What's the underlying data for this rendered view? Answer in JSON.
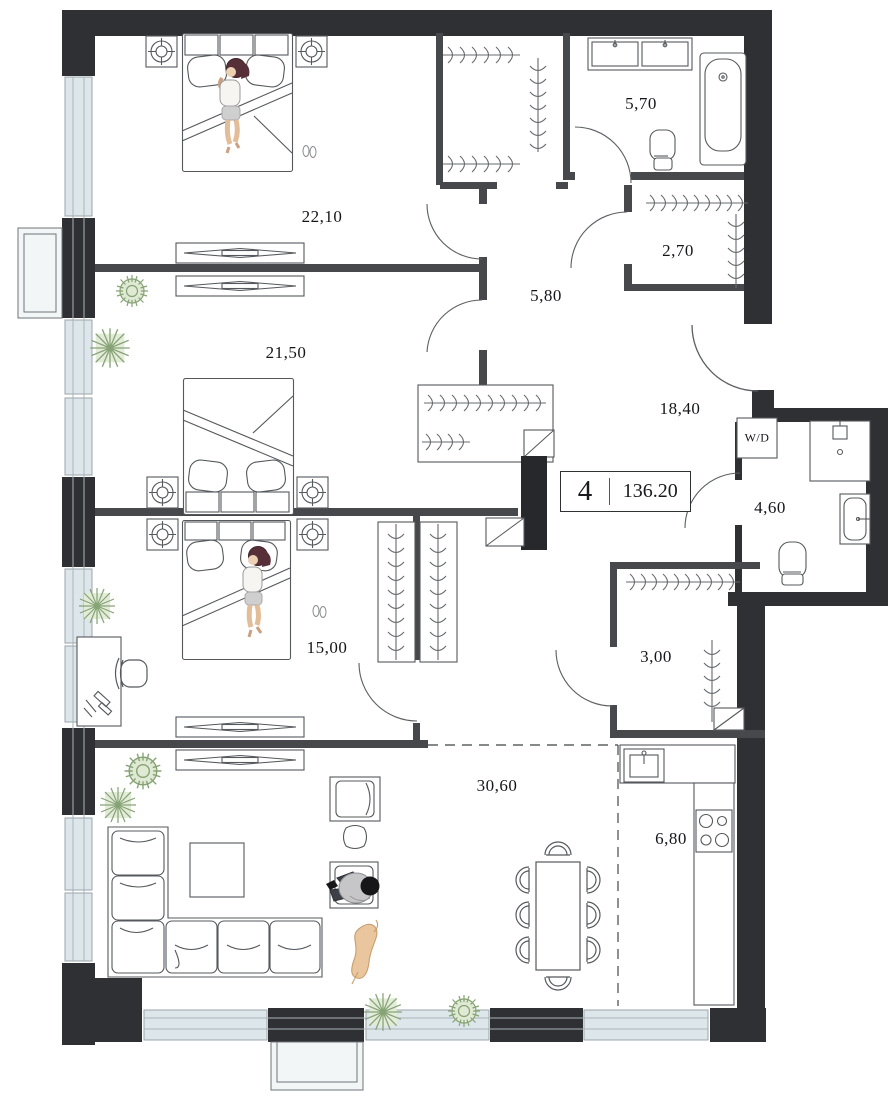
{
  "floor_plan": {
    "unit_badge": {
      "rooms_count": "4",
      "total_area": "136.20"
    },
    "room_areas": {
      "bedroom_top": "22,10",
      "bathroom_top": "5,70",
      "dressing_top": "2,70",
      "hallway_inner": "5,80",
      "bedroom_middle": "21,50",
      "hallway_entry": "18,40",
      "bathroom_side": "4,60",
      "bedroom_lower": "15,00",
      "dressing_middle": "3,00",
      "living_room": "30,60",
      "kitchen": "6,80"
    },
    "appliance_labels": {
      "washer_dryer": "W/D"
    },
    "colors": {
      "wall": "#2e3033",
      "interior_wall": "#46484c",
      "glazing": "#dde6ea",
      "plant": "#8ba578",
      "skin": "#ecd0b4"
    }
  }
}
